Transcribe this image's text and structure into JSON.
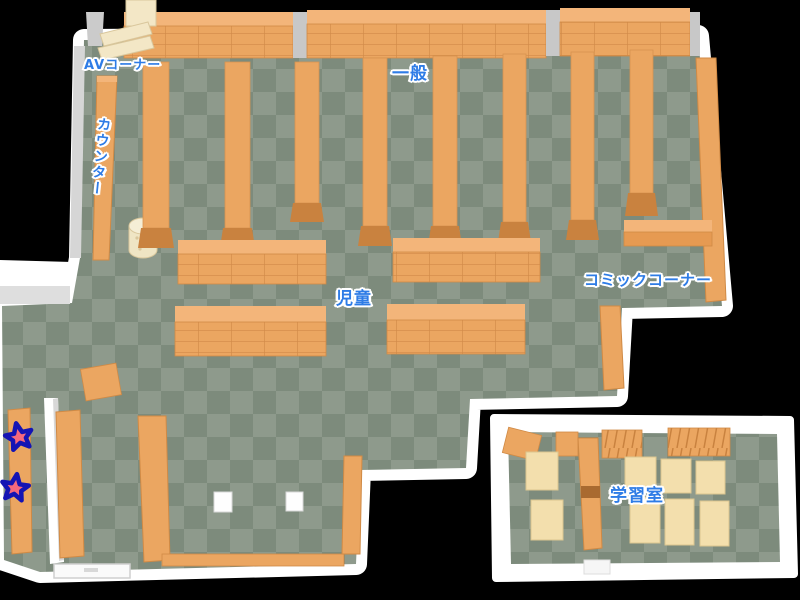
{
  "floor_map": {
    "labels": {
      "av_corner": "AVコーナー",
      "general": "一般",
      "counter": "カウンター",
      "children": "児童",
      "comic_corner": "コミックコーナー",
      "study_room": "学習室"
    },
    "markers": {
      "star_count": 2
    },
    "palette": {
      "background": "#000000",
      "wall": "#ffffff",
      "wall_shade": "#d6d6d6",
      "floor_light": "#8e9a8c",
      "floor_dark": "#7d8b7c",
      "shelf": "#eba661",
      "shelf_top": "#f3b57a",
      "shelf_side": "#c9823f",
      "shelf_line": "#cf8845",
      "av_shelf": "#f3e7c6",
      "desk": "#f3dfad",
      "label_text": "#2e7ce6",
      "label_outline": "#ffffff",
      "star_fill": "#f4687d",
      "star_outline": "#1414b4"
    }
  }
}
